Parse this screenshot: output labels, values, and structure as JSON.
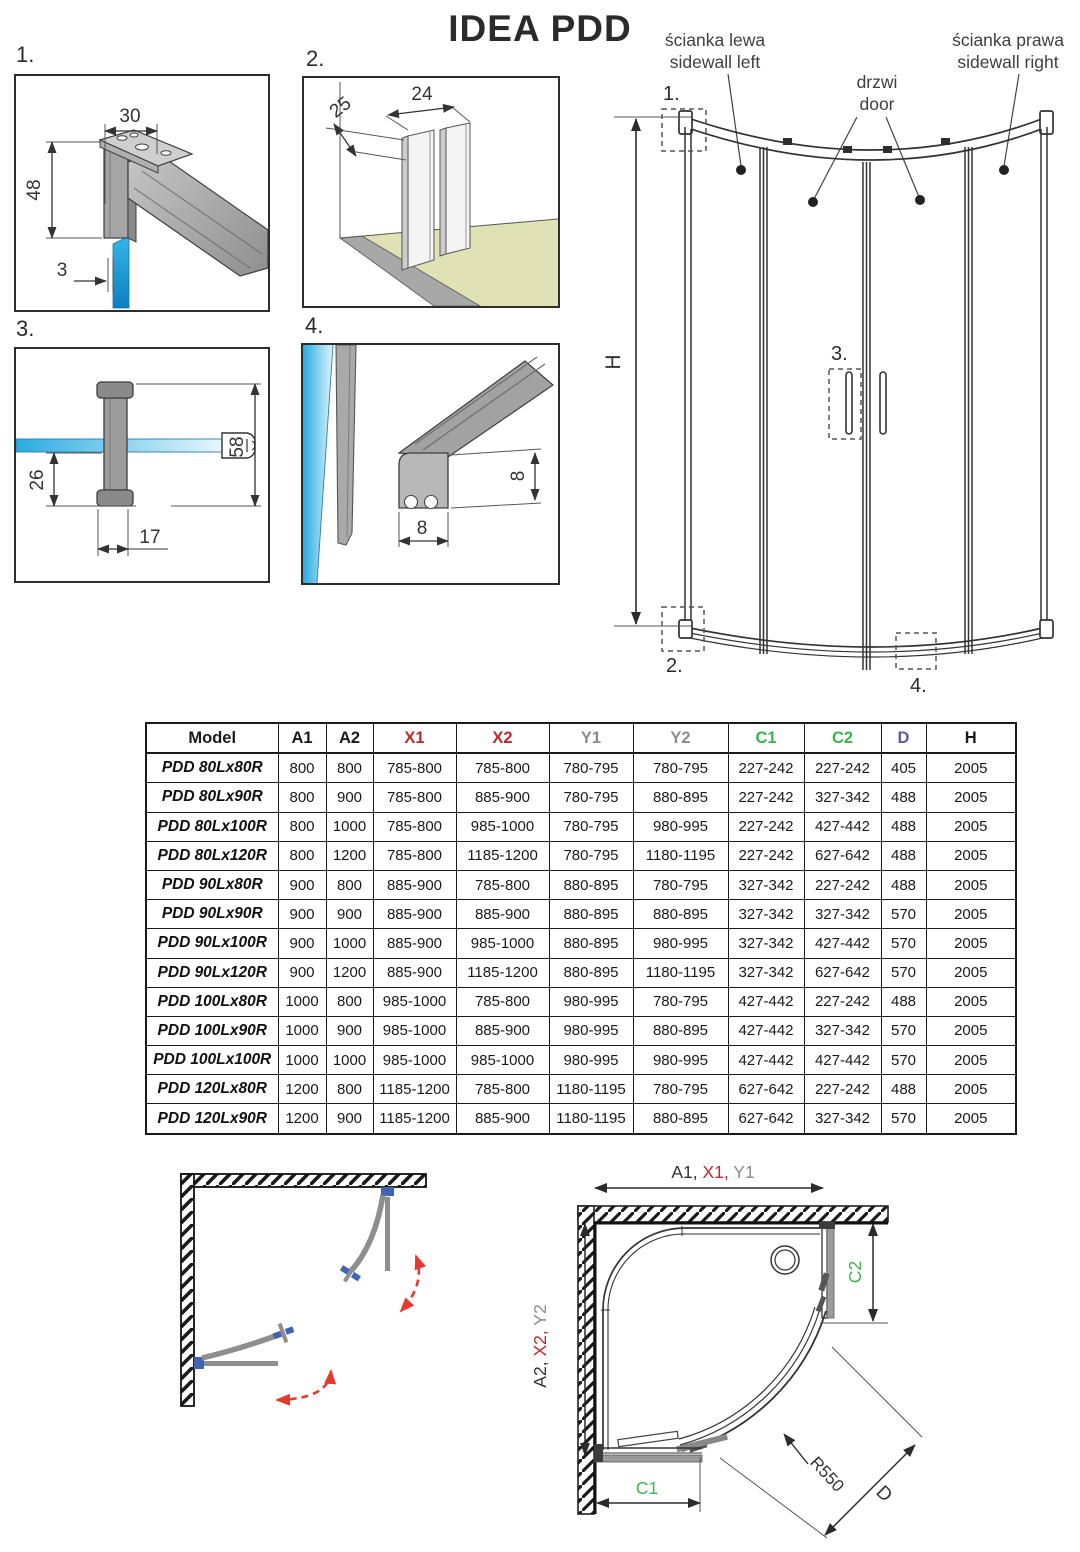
{
  "title": "IDEA PDD",
  "details": {
    "d1": {
      "label": "1.",
      "dim_top": "30",
      "dim_left": "48",
      "dim_gap": "3"
    },
    "d2": {
      "label": "2.",
      "dim_depth": "25",
      "dim_width": "24"
    },
    "d3": {
      "label": "3.",
      "dim_offset": "26",
      "dim_width": "17",
      "dim_height": "58"
    },
    "d4": {
      "label": "4.",
      "dim_height": "8",
      "dim_width": "8"
    }
  },
  "elevation": {
    "sidewall_left_pl": "ścianka lewa",
    "sidewall_left_en": "sidewall left",
    "door_pl": "drzwi",
    "door_en": "door",
    "sidewall_right_pl": "ścianka prawa",
    "sidewall_right_en": "sidewall right",
    "height_label": "H",
    "marker_1": "1.",
    "marker_2": "2.",
    "marker_3": "3.",
    "marker_4": "4."
  },
  "table": {
    "columns": [
      {
        "label": "Model",
        "color": "#1a1a1a"
      },
      {
        "label": "A1",
        "color": "#1a1a1a"
      },
      {
        "label": "A2",
        "color": "#1a1a1a"
      },
      {
        "label": "X1",
        "color": "#c1272d"
      },
      {
        "label": "X2",
        "color": "#c1272d"
      },
      {
        "label": "Y1",
        "color": "#8c8c8c"
      },
      {
        "label": "Y2",
        "color": "#8c8c8c"
      },
      {
        "label": "C1",
        "color": "#39b54a"
      },
      {
        "label": "C2",
        "color": "#39b54a"
      },
      {
        "label": "D",
        "color": "#5e5aa2"
      },
      {
        "label": "H",
        "color": "#1a1a1a"
      }
    ],
    "rows": [
      {
        "model": "PDD 80Lx80R",
        "values": [
          "800",
          "800",
          "785-800",
          "785-800",
          "780-795",
          "780-795",
          "227-242",
          "227-242",
          "405",
          "2005"
        ]
      },
      {
        "model": "PDD 80Lx90R",
        "values": [
          "800",
          "900",
          "785-800",
          "885-900",
          "780-795",
          "880-895",
          "227-242",
          "327-342",
          "488",
          "2005"
        ]
      },
      {
        "model": "PDD 80Lx100R",
        "values": [
          "800",
          "1000",
          "785-800",
          "985-1000",
          "780-795",
          "980-995",
          "227-242",
          "427-442",
          "488",
          "2005"
        ]
      },
      {
        "model": "PDD 80Lx120R",
        "values": [
          "800",
          "1200",
          "785-800",
          "1185-1200",
          "780-795",
          "1180-1195",
          "227-242",
          "627-642",
          "488",
          "2005"
        ]
      },
      {
        "model": "PDD 90Lx80R",
        "values": [
          "900",
          "800",
          "885-900",
          "785-800",
          "880-895",
          "780-795",
          "327-342",
          "227-242",
          "488",
          "2005"
        ]
      },
      {
        "model": "PDD 90Lx90R",
        "values": [
          "900",
          "900",
          "885-900",
          "885-900",
          "880-895",
          "880-895",
          "327-342",
          "327-342",
          "570",
          "2005"
        ]
      },
      {
        "model": "PDD 90Lx100R",
        "values": [
          "900",
          "1000",
          "885-900",
          "985-1000",
          "880-895",
          "980-995",
          "327-342",
          "427-442",
          "570",
          "2005"
        ]
      },
      {
        "model": "PDD 90Lx120R",
        "values": [
          "900",
          "1200",
          "885-900",
          "1185-1200",
          "880-895",
          "1180-1195",
          "327-342",
          "627-642",
          "570",
          "2005"
        ]
      },
      {
        "model": "PDD 100Lx80R",
        "values": [
          "1000",
          "800",
          "985-1000",
          "785-800",
          "980-995",
          "780-795",
          "427-442",
          "227-242",
          "488",
          "2005"
        ]
      },
      {
        "model": "PDD 100Lx90R",
        "values": [
          "1000",
          "900",
          "985-1000",
          "885-900",
          "980-995",
          "880-895",
          "427-442",
          "327-342",
          "570",
          "2005"
        ]
      },
      {
        "model": "PDD 100Lx100R",
        "values": [
          "1000",
          "1000",
          "985-1000",
          "985-1000",
          "980-995",
          "980-995",
          "427-442",
          "427-442",
          "570",
          "2005"
        ]
      },
      {
        "model": "PDD 120Lx80R",
        "values": [
          "1200",
          "800",
          "1185-1200",
          "785-800",
          "1180-1195",
          "780-795",
          "627-642",
          "227-242",
          "488",
          "2005"
        ]
      },
      {
        "model": "PDD 120Lx90R",
        "values": [
          "1200",
          "900",
          "1185-1200",
          "885-900",
          "1180-1195",
          "880-895",
          "627-642",
          "327-342",
          "570",
          "2005"
        ]
      }
    ]
  },
  "plan": {
    "dim_top_a1": "A1, ",
    "dim_top_x1": "X1, ",
    "dim_top_y1": "Y1",
    "dim_left_a2": "A2, ",
    "dim_left_x2": "X2, ",
    "dim_left_y2": "Y2",
    "dim_c1": "C1",
    "dim_c2": "C2",
    "radius_label": "R550",
    "diameter_label": "D"
  },
  "colors": {
    "dim_red": "#c1272d",
    "dim_gray": "#8c8c8c",
    "dim_green": "#39b54a",
    "dim_purple": "#5e5aa2",
    "glass_blue": "#29abe2",
    "floor_khaki": "#e0e1b4",
    "profile_gray": "#a9a9a9",
    "arrow_red": "#e8392e",
    "bracket_blue": "#3f63b5"
  }
}
